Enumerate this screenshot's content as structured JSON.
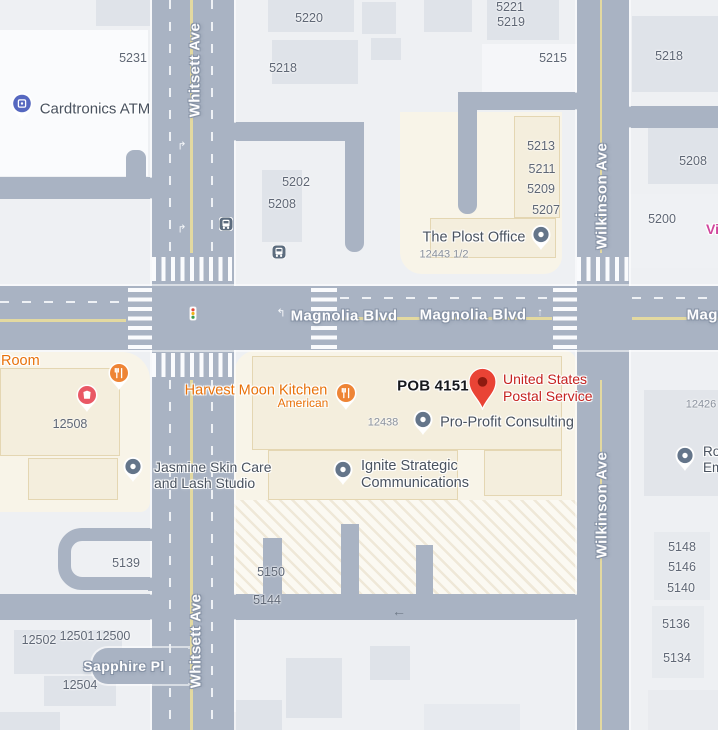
{
  "map": {
    "colors": {
      "road": "#a9b3c3",
      "commercial_block": "#f8f4e8",
      "destination_pin": "#e94335",
      "restaurant_poi": "#ee8435",
      "atm_poi": "#5668c0",
      "red_poi": "#e95865",
      "generic_poi": "#64758a"
    },
    "streets": [
      {
        "id": "street-whitsett-ave-north",
        "name": "Whitsett Ave",
        "cls": "v",
        "x": 195,
        "y": 70
      },
      {
        "id": "street-whitsett-ave-south",
        "name": "Whitsett Ave",
        "cls": "v",
        "x": 196,
        "y": 641
      },
      {
        "id": "street-wilkinson-ave-north",
        "name": "Wilkinson Ave",
        "cls": "v",
        "x": 602,
        "y": 196
      },
      {
        "id": "street-wilkinson-ave-south",
        "name": "Wilkinson Ave",
        "cls": "v",
        "x": 602,
        "y": 505
      },
      {
        "id": "street-magnolia-blvd-west",
        "name": "Magnolia Blvd",
        "cls": "h",
        "x": 344,
        "y": 316
      },
      {
        "id": "street-magnolia-blvd-east",
        "name": "Magnolia Blvd",
        "cls": "h",
        "x": 473,
        "y": 315
      },
      {
        "id": "street-magnolia-blvd-edge",
        "name": "Magnolia Blvd",
        "cls": "h",
        "x": 740,
        "y": 315
      },
      {
        "id": "street-sapphire-pl",
        "name": "Sapphire Pl",
        "cls": "h",
        "x": 124,
        "y": 666,
        "fs": 14
      }
    ],
    "parcels": [
      {
        "t": "5231",
        "x": 133,
        "y": 58
      },
      {
        "t": "5220",
        "x": 309,
        "y": 18
      },
      {
        "t": "5218",
        "x": 283,
        "y": 68
      },
      {
        "t": "5221",
        "x": 510,
        "y": 7
      },
      {
        "t": "5219",
        "x": 511,
        "y": 22
      },
      {
        "t": "5215",
        "x": 553,
        "y": 58
      },
      {
        "t": "5218",
        "x": 669,
        "y": 56
      },
      {
        "t": "5202",
        "x": 296,
        "y": 182
      },
      {
        "t": "5208",
        "x": 282,
        "y": 204
      },
      {
        "t": "5213",
        "x": 541,
        "y": 146
      },
      {
        "t": "5211",
        "x": 542,
        "y": 169
      },
      {
        "t": "5209",
        "x": 541,
        "y": 189
      },
      {
        "t": "5207",
        "x": 546,
        "y": 210
      },
      {
        "t": "5208",
        "x": 693,
        "y": 161
      },
      {
        "t": "5200",
        "x": 662,
        "y": 219
      },
      {
        "t": "12443 1/2",
        "x": 444,
        "y": 255,
        "cls": "tiny"
      },
      {
        "t": "12438",
        "x": 383,
        "y": 423,
        "cls": "tiny"
      },
      {
        "t": "12426",
        "x": 701,
        "y": 405,
        "cls": "tiny"
      },
      {
        "t": "12508",
        "x": 70,
        "y": 424
      },
      {
        "t": "5139",
        "x": 126,
        "y": 563
      },
      {
        "t": "5150",
        "x": 271,
        "y": 572
      },
      {
        "t": "5144",
        "x": 267,
        "y": 600
      },
      {
        "t": "12502",
        "x": 39,
        "y": 640
      },
      {
        "t": "12501",
        "x": 77,
        "y": 636
      },
      {
        "t": "12500",
        "x": 113,
        "y": 636
      },
      {
        "t": "12504",
        "x": 80,
        "y": 685
      },
      {
        "t": "5148",
        "x": 682,
        "y": 547
      },
      {
        "t": "5146",
        "x": 682,
        "y": 567
      },
      {
        "t": "5140",
        "x": 681,
        "y": 588
      },
      {
        "t": "5136",
        "x": 676,
        "y": 624
      },
      {
        "t": "5134",
        "x": 677,
        "y": 658
      }
    ],
    "places": [
      {
        "id": "place-cardtronics-atm",
        "label": "Cardtronics ATM",
        "cls": "dark",
        "x": 95,
        "y": 109,
        "fs": 15
      },
      {
        "id": "place-the-plost-office",
        "label": "The Plost Office",
        "cls": "dark",
        "x": 474,
        "y": 238
      },
      {
        "id": "place-room",
        "label": "Room",
        "cls": "orange left",
        "x": 1,
        "y": 353
      },
      {
        "id": "place-harvest-moon-kitchen",
        "label": "Harvest Moon Kitchen",
        "cls": "orange",
        "x": 256,
        "y": 391
      },
      {
        "id": "place-harvest-moon-kitchen-cuisine",
        "label": "American",
        "cls": "orange",
        "x": 303,
        "y": 404,
        "fs": 12
      },
      {
        "id": "place-pob-4151",
        "label": "POB 4151",
        "cls": "pob",
        "x": 433,
        "y": 386,
        "fs": 15
      },
      {
        "id": "place-united-states-postal-service",
        "label": "United States\nPostal Service",
        "cls": "red left",
        "x": 503,
        "y": 371,
        "fs": 14,
        "lh": 17
      },
      {
        "id": "place-pro-profit-consulting",
        "label": "Pro-Profit Consulting",
        "cls": "dark",
        "x": 507,
        "y": 423
      },
      {
        "id": "place-ignite-strategic-communications",
        "label": "Ignite Strategic\nCommunications",
        "cls": "dark left",
        "x": 361,
        "y": 458,
        "lh": 17
      },
      {
        "id": "place-jasmine-skin-care",
        "label": "Jasmine Skin Care\nand Lash Studio",
        "cls": "dark left",
        "x": 154,
        "y": 459,
        "fs": 14,
        "lh": 16
      },
      {
        "id": "place-ro-em",
        "label": "Ro\nEm",
        "cls": "dark left",
        "x": 703,
        "y": 444,
        "fs": 13.5,
        "lh": 15.5
      },
      {
        "id": "place-vi",
        "label": "Vi",
        "cls": "pink left",
        "x": 706,
        "y": 221,
        "fs": 14
      }
    ],
    "markings": [
      {
        "id": "turn-arrow",
        "glyph": "↱",
        "cls": "white",
        "x": 182,
        "y": 147
      },
      {
        "id": "turn-arrow",
        "glyph": "↱",
        "cls": "white",
        "x": 182,
        "y": 230
      },
      {
        "id": "turn-arrow",
        "glyph": "↰",
        "cls": "white",
        "x": 281,
        "y": 314
      },
      {
        "id": "turn-arrow",
        "glyph": "↑",
        "cls": "white",
        "x": 540,
        "y": 313
      },
      {
        "id": "alley-arrow",
        "glyph": "←",
        "cls": "slate",
        "x": 399,
        "y": 611
      }
    ]
  }
}
